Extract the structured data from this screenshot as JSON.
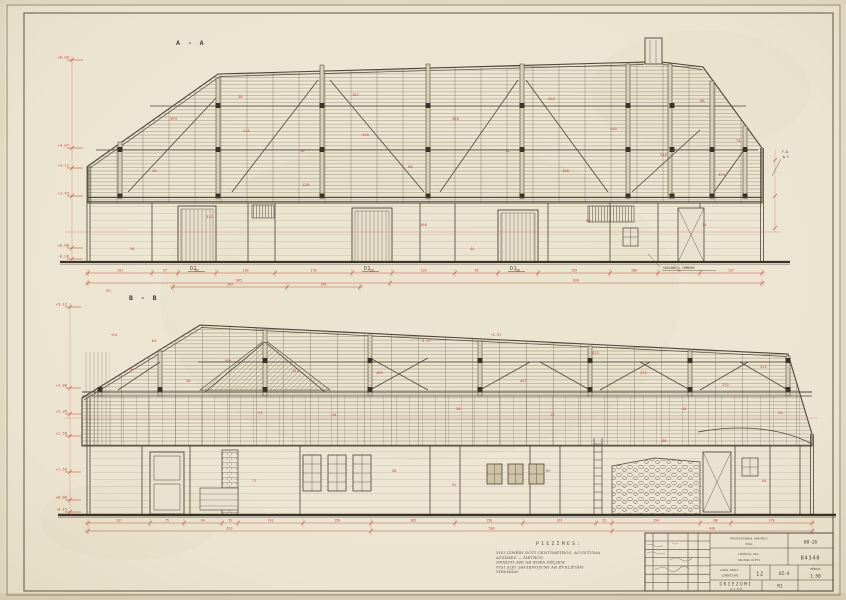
{
  "colors": {
    "paper": "#ece4d0",
    "ink": "#4d4537",
    "dimension_red": "#b84a3d",
    "boards": "#84775f"
  },
  "section_a": {
    "label": "A - A",
    "door_labels": [
      "D2",
      "D2",
      "D1"
    ],
    "fd_label": "F.D.",
    "fd_sub": "№ 2",
    "side_note": "SAGLABĀTS TAMBURS",
    "elevations": {
      "x": 72,
      "items": [
        {
          "y": 60,
          "t": "+8.04"
        },
        {
          "y": 148,
          "t": "+4.07"
        },
        {
          "y": 168,
          "t": "+3.12"
        },
        {
          "y": 196,
          "t": "+1.43"
        },
        {
          "y": 248,
          "t": "±0.00"
        },
        {
          "y": 259,
          "t": "-0.28"
        }
      ]
    },
    "annotations": [
      {
        "x": 170,
        "y": 120,
        "t": "393"
      },
      {
        "x": 238,
        "y": 98,
        "t": "28"
      },
      {
        "x": 243,
        "y": 132,
        "t": "415"
      },
      {
        "x": 300,
        "y": 152,
        "t": "30"
      },
      {
        "x": 352,
        "y": 96,
        "t": "107"
      },
      {
        "x": 362,
        "y": 136,
        "t": "415"
      },
      {
        "x": 408,
        "y": 168,
        "t": "80"
      },
      {
        "x": 302,
        "y": 186,
        "t": "120"
      },
      {
        "x": 452,
        "y": 120,
        "t": "385"
      },
      {
        "x": 505,
        "y": 152,
        "t": "14"
      },
      {
        "x": 548,
        "y": 100,
        "t": "292"
      },
      {
        "x": 562,
        "y": 172,
        "t": "186"
      },
      {
        "x": 610,
        "y": 130,
        "t": "440"
      },
      {
        "x": 660,
        "y": 156,
        "t": "246"
      },
      {
        "x": 700,
        "y": 102,
        "t": "68"
      },
      {
        "x": 718,
        "y": 176,
        "t": "325"
      },
      {
        "x": 736,
        "y": 142,
        "t": "78"
      },
      {
        "x": 152,
        "y": 172,
        "t": "28"
      },
      {
        "x": 206,
        "y": 218,
        "t": "312"
      },
      {
        "x": 420,
        "y": 226,
        "t": "188"
      },
      {
        "x": 586,
        "y": 222,
        "t": "96"
      },
      {
        "x": 702,
        "y": 226,
        "t": "74"
      },
      {
        "x": 130,
        "y": 250,
        "t": "58"
      },
      {
        "x": 470,
        "y": 250,
        "t": "44"
      }
    ],
    "chains": {
      "c1": {
        "y": 273,
        "ticks": [
          88,
          152,
          178,
          216,
          275,
          352,
          392,
          455,
          498,
          538,
          610,
          658,
          700,
          762
        ],
        "labels": [
          "141",
          "57",
          "85",
          "130",
          "170",
          "88",
          "139",
          "95",
          "88",
          "159",
          "106",
          "92",
          "137"
        ]
      },
      "c2": {
        "y": 283,
        "ticks": [
          88,
          390,
          762
        ],
        "labels": [
          "665",
          "820"
        ]
      }
    }
  },
  "section_b": {
    "label": "B - B",
    "elevations": {
      "x": 70,
      "items": [
        {
          "y": 307,
          "t": "+5.12"
        },
        {
          "y": 388,
          "t": "+3.80"
        },
        {
          "y": 414,
          "t": "+3.36"
        },
        {
          "y": 436,
          "t": "+2.58"
        },
        {
          "y": 472,
          "t": "+1.50"
        },
        {
          "y": 500,
          "t": "±0.00"
        },
        {
          "y": 512,
          "t": "-0.15"
        }
      ]
    },
    "annotations": [
      {
        "x": 128,
        "y": 370,
        "t": "41"
      },
      {
        "x": 152,
        "y": 342,
        "t": "64"
      },
      {
        "x": 186,
        "y": 382,
        "t": "28"
      },
      {
        "x": 224,
        "y": 362,
        "t": "180"
      },
      {
        "x": 258,
        "y": 414,
        "t": "23"
      },
      {
        "x": 292,
        "y": 372,
        "t": "312"
      },
      {
        "x": 332,
        "y": 416,
        "t": "44"
      },
      {
        "x": 376,
        "y": 374,
        "t": "405"
      },
      {
        "x": 422,
        "y": 342,
        "t": "4.57"
      },
      {
        "x": 456,
        "y": 410,
        "t": "28"
      },
      {
        "x": 520,
        "y": 382,
        "t": "457"
      },
      {
        "x": 550,
        "y": 416,
        "t": "12"
      },
      {
        "x": 592,
        "y": 354,
        "t": "412"
      },
      {
        "x": 640,
        "y": 374,
        "t": "312"
      },
      {
        "x": 682,
        "y": 410,
        "t": "44"
      },
      {
        "x": 722,
        "y": 386,
        "t": "232"
      },
      {
        "x": 760,
        "y": 368,
        "t": "412"
      },
      {
        "x": 778,
        "y": 414,
        "t": "28"
      },
      {
        "x": 252,
        "y": 482,
        "t": "77"
      },
      {
        "x": 392,
        "y": 472,
        "t": "58"
      },
      {
        "x": 452,
        "y": 486,
        "t": "91"
      },
      {
        "x": 546,
        "y": 472,
        "t": "85"
      },
      {
        "x": 762,
        "y": 482,
        "t": "64"
      },
      {
        "x": 662,
        "y": 442,
        "t": "88"
      },
      {
        "x": 110,
        "y": 336,
        "t": "~64"
      },
      {
        "x": 490,
        "y": 336,
        "t": "~4.57"
      },
      {
        "x": 106,
        "y": 292,
        "t": "2%"
      }
    ],
    "chains": {
      "top": {
        "y": 287,
        "ticks": [
          173,
          287,
          360
        ],
        "labels": [
          "163",
          "161"
        ]
      },
      "c1": {
        "y": 523,
        "ticks": [
          88,
          150,
          184,
          222,
          238,
          303,
          371,
          455,
          523,
          596,
          612,
          700,
          731,
          812
        ],
        "labels": [
          "137",
          "75",
          "84",
          "35",
          "143",
          "150",
          "185",
          "150",
          "161",
          "35",
          "194",
          "68",
          "178"
        ]
      },
      "c2": {
        "y": 531,
        "ticks": [
          88,
          371,
          612,
          812
        ],
        "labels": [
          "623",
          "530",
          "440"
        ]
      }
    }
  },
  "notes": {
    "heading": "PIEZĪMES:",
    "lines": [
      "VISI IZMĒRI DOTI CENTIMETROS, AUGSTUMA",
      "ATZĪMES — METROS.",
      "GRIESTI ABI AR KOKA DĒĻIEM.",
      "VISI SIJU SAVIENOJUMI AR ĒVELĒTĀM",
      "VIRSMĀM."
    ]
  },
  "title_block": {
    "org_line1": "PROJEKTĒŠANAS KANTORIS",
    "org_line2": "RĪGA",
    "code_top": "88-26",
    "object_line1": "LIEPĀJAS RAJ.",
    "object_line2": "KOLHOZA KLĒTS",
    "code_main": "B4340",
    "stage_line1": "LAUKU ARHIT.",
    "stage_line2": "UZMĒRĪJUMS",
    "sheet_no": "12",
    "doc_code": "UZ-4",
    "scale_caption": "MĒROGS",
    "scale": "1:50",
    "title_line1": "GRIEZUMI",
    "title_line2": "A-A  B-B",
    "stamp": "R1"
  }
}
